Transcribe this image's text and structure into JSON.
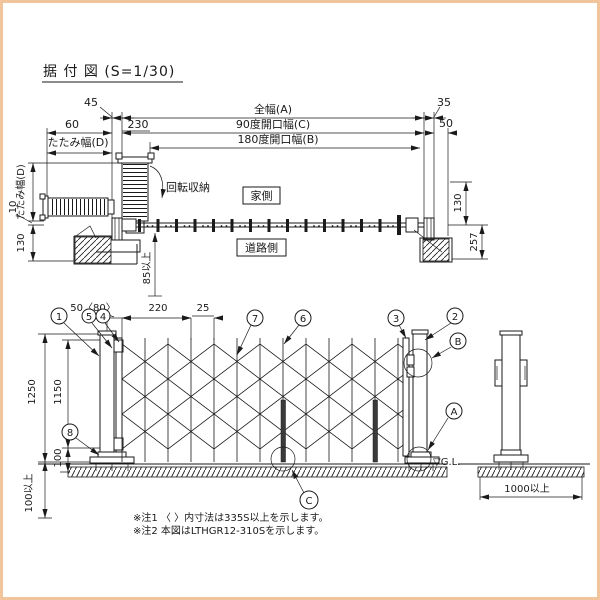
{
  "frame": {
    "border_color": "#f2c49c"
  },
  "title": "据 付 図 (S=1/30)",
  "plan": {
    "d45": "45",
    "full_width": "全幅(A)",
    "d35": "35",
    "d60": "60",
    "d230": "230",
    "open90": "90度開口幅(C)",
    "d50": "50",
    "fold_width_top": "たたみ幅(D)",
    "open180": "180度開口幅(B)",
    "fold_width_left": "たたみ幅(D)",
    "d10": "10",
    "d130_left": "130",
    "d85": "85以上",
    "d130_right": "130",
    "d257": "257",
    "rotate_storage": "回転収納",
    "house_side": "家側",
    "road_side": "道路側"
  },
  "elev": {
    "d50_80": "50〈80〉",
    "d220": "220",
    "d25": "25",
    "d1250": "1250",
    "d1150": "1150",
    "d100": "100",
    "d100_min": "100以上",
    "d1000_min": "1000以上",
    "gl": "▽G.L.",
    "balloons": {
      "n1": "1",
      "n2": "2",
      "n3": "3",
      "n4": "4",
      "n5": "5",
      "n6": "6",
      "n7": "7",
      "n8": "8",
      "a": "A",
      "b": "B",
      "c": "C"
    }
  },
  "notes": {
    "note1": "※注1 〈 〉内寸法は335S以上を示します。",
    "note2": "※注2 本図はLTHGR12-310Sを示します。"
  }
}
